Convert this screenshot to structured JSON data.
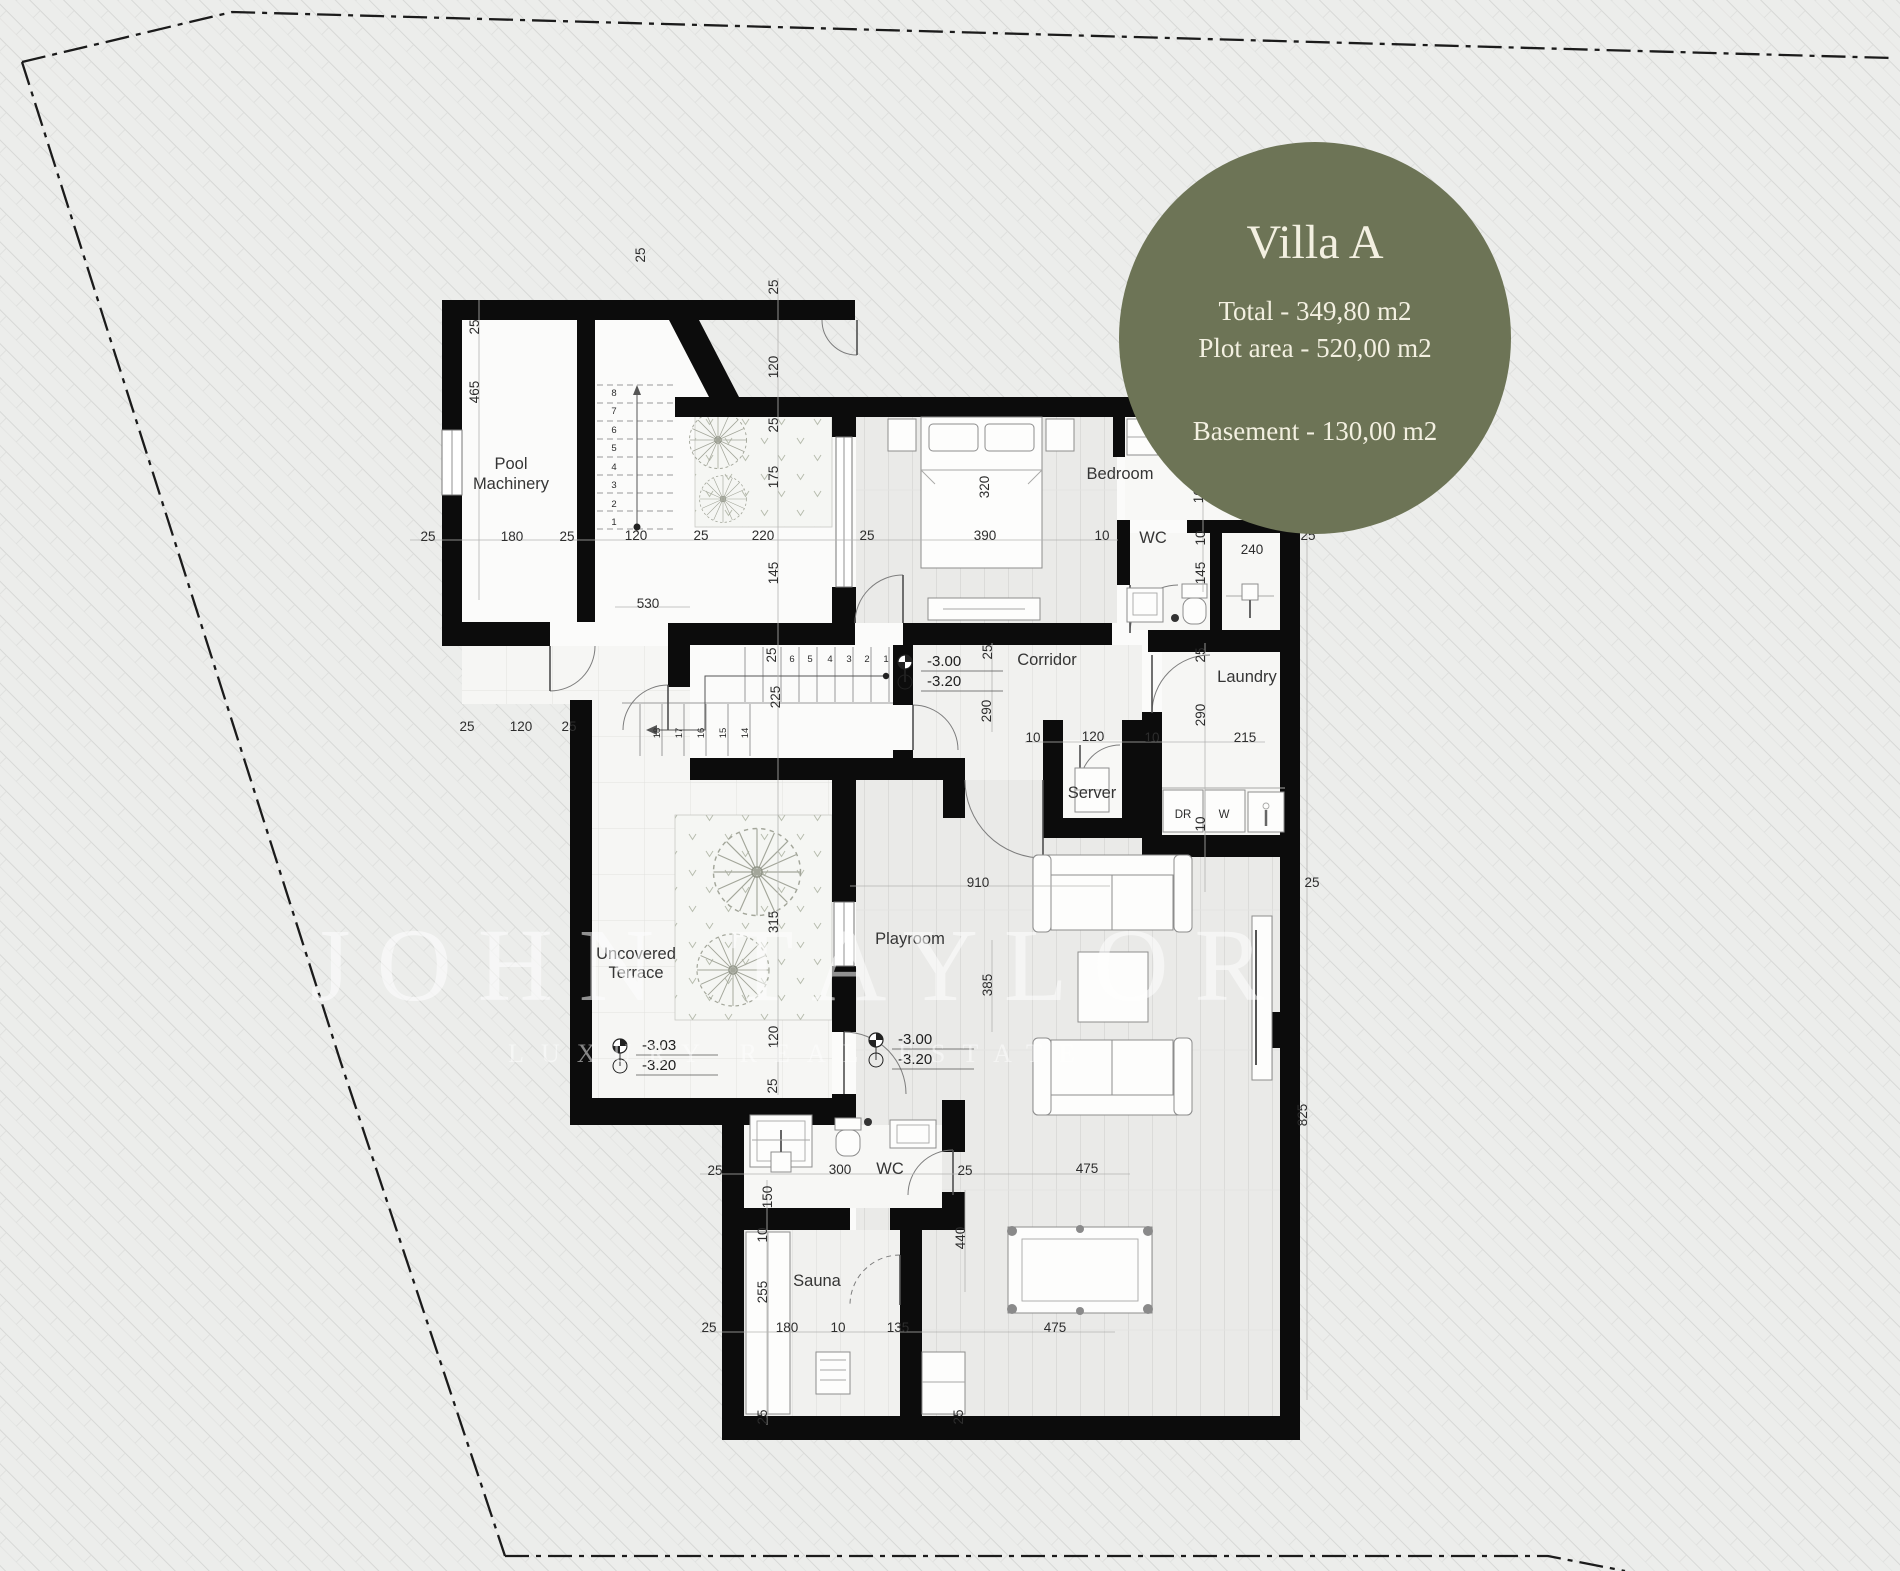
{
  "badge": {
    "title": "Villa A",
    "line1": "Total - 349,80 m2",
    "line2": "Plot area - 520,00 m2",
    "line3": "Basement - 130,00 m2"
  },
  "watermark": {
    "line1": "JOHN TAYLOR",
    "line2": "LUXURY REAL ESTATE"
  },
  "colors": {
    "badge_bg": "#6d7456",
    "badge_fg": "#f3f0e1",
    "wall": "#0c0c0c",
    "paper": "#ecedeb",
    "tree": "#a3a69a"
  },
  "plan": {
    "rooms": [
      {
        "t": "Pool",
        "x": 511,
        "y": 469
      },
      {
        "t": "Machinery",
        "x": 511,
        "y": 489
      },
      {
        "t": "Bedroom",
        "x": 1120,
        "y": 479
      },
      {
        "t": "WC",
        "x": 1153,
        "y": 543
      },
      {
        "t": "Corridor",
        "x": 1047,
        "y": 665
      },
      {
        "t": "Laundry",
        "x": 1247,
        "y": 682
      },
      {
        "t": "Server",
        "x": 1092,
        "y": 798
      },
      {
        "t": "Uncovered",
        "x": 636,
        "y": 959
      },
      {
        "t": "Terrace",
        "x": 636,
        "y": 978
      },
      {
        "t": "Playroom",
        "x": 910,
        "y": 944
      },
      {
        "t": "WC",
        "x": 890,
        "y": 1174
      },
      {
        "t": "Sauna",
        "x": 817,
        "y": 1286
      }
    ],
    "dims": [
      {
        "t": "25",
        "x": 428,
        "y": 541
      },
      {
        "t": "180",
        "x": 512,
        "y": 541
      },
      {
        "t": "25",
        "x": 567,
        "y": 541
      },
      {
        "t": "120",
        "x": 636,
        "y": 540
      },
      {
        "t": "25",
        "x": 701,
        "y": 540
      },
      {
        "t": "220",
        "x": 763,
        "y": 540
      },
      {
        "t": "25",
        "x": 867,
        "y": 540
      },
      {
        "t": "390",
        "x": 985,
        "y": 540
      },
      {
        "t": "10",
        "x": 1102,
        "y": 540
      },
      {
        "t": "25",
        "x": 479,
        "y": 327,
        "r": 1
      },
      {
        "t": "465",
        "x": 479,
        "y": 392,
        "r": 1
      },
      {
        "t": "25",
        "x": 645,
        "y": 255,
        "r": 1
      },
      {
        "t": "25",
        "x": 778,
        "y": 287,
        "r": 1
      },
      {
        "t": "120",
        "x": 778,
        "y": 367,
        "r": 1
      },
      {
        "t": "25",
        "x": 778,
        "y": 425,
        "r": 1
      },
      {
        "t": "175",
        "x": 778,
        "y": 477,
        "r": 1
      },
      {
        "t": "145",
        "x": 778,
        "y": 573,
        "r": 1
      },
      {
        "t": "25",
        "x": 776,
        "y": 655,
        "r": 1
      },
      {
        "t": "225",
        "x": 780,
        "y": 697,
        "r": 1
      },
      {
        "t": "320",
        "x": 989,
        "y": 487,
        "r": 1
      },
      {
        "t": "530",
        "x": 648,
        "y": 608
      },
      {
        "t": "25",
        "x": 467,
        "y": 731
      },
      {
        "t": "120",
        "x": 521,
        "y": 731
      },
      {
        "t": "25",
        "x": 569,
        "y": 731
      },
      {
        "t": "25",
        "x": 1203,
        "y": 383,
        "r": 1
      },
      {
        "t": "165",
        "x": 1203,
        "y": 492,
        "r": 1
      },
      {
        "t": "10",
        "x": 1205,
        "y": 538,
        "r": 1
      },
      {
        "t": "145",
        "x": 1205,
        "y": 573,
        "r": 1
      },
      {
        "t": "240",
        "x": 1252,
        "y": 554
      },
      {
        "t": "25",
        "x": 1308,
        "y": 540
      },
      {
        "t": "25",
        "x": 992,
        "y": 652,
        "r": 1
      },
      {
        "t": "290",
        "x": 991,
        "y": 711,
        "r": 1
      },
      {
        "t": "25",
        "x": 1205,
        "y": 655,
        "r": 1
      },
      {
        "t": "290",
        "x": 1205,
        "y": 715,
        "r": 1
      },
      {
        "t": "215",
        "x": 1245,
        "y": 742
      },
      {
        "t": "10",
        "x": 1033,
        "y": 742
      },
      {
        "t": "120",
        "x": 1093,
        "y": 741
      },
      {
        "t": "10",
        "x": 1152,
        "y": 742
      },
      {
        "t": "DR",
        "x": 1183,
        "y": 818,
        "s": 11
      },
      {
        "t": "W",
        "x": 1224,
        "y": 818,
        "s": 11
      },
      {
        "t": "10",
        "x": 1205,
        "y": 824,
        "r": 1
      },
      {
        "t": "25",
        "x": 1312,
        "y": 887
      },
      {
        "t": "910",
        "x": 978,
        "y": 887
      },
      {
        "t": "385",
        "x": 992,
        "y": 985,
        "r": 1
      },
      {
        "t": "825",
        "x": 1307,
        "y": 1115,
        "r": 1
      },
      {
        "t": "315",
        "x": 778,
        "y": 922,
        "r": 1
      },
      {
        "t": "120",
        "x": 778,
        "y": 1037,
        "r": 1
      },
      {
        "t": "25",
        "x": 777,
        "y": 1086,
        "r": 1
      },
      {
        "t": "25",
        "x": 715,
        "y": 1175
      },
      {
        "t": "300",
        "x": 840,
        "y": 1174
      },
      {
        "t": "25",
        "x": 965,
        "y": 1175
      },
      {
        "t": "475",
        "x": 1087,
        "y": 1173
      },
      {
        "t": "150",
        "x": 772,
        "y": 1197,
        "r": 1
      },
      {
        "t": "10",
        "x": 767,
        "y": 1235,
        "r": 1
      },
      {
        "t": "255",
        "x": 767,
        "y": 1292,
        "r": 1
      },
      {
        "t": "440",
        "x": 965,
        "y": 1238,
        "r": 1
      },
      {
        "t": "25",
        "x": 709,
        "y": 1332
      },
      {
        "t": "180",
        "x": 787,
        "y": 1332
      },
      {
        "t": "10",
        "x": 838,
        "y": 1332
      },
      {
        "t": "135",
        "x": 898,
        "y": 1332
      },
      {
        "t": "475",
        "x": 1055,
        "y": 1332
      },
      {
        "t": "25",
        "x": 767,
        "y": 1417,
        "r": 1
      },
      {
        "t": "25",
        "x": 963,
        "y": 1417,
        "r": 1
      }
    ],
    "stairs": [
      {
        "t": "8",
        "x": 614,
        "y": 396
      },
      {
        "t": "7",
        "x": 614,
        "y": 414
      },
      {
        "t": "6",
        "x": 614,
        "y": 433
      },
      {
        "t": "5",
        "x": 614,
        "y": 451
      },
      {
        "t": "4",
        "x": 614,
        "y": 470
      },
      {
        "t": "3",
        "x": 614,
        "y": 488
      },
      {
        "t": "2",
        "x": 614,
        "y": 507
      },
      {
        "t": "1",
        "x": 614,
        "y": 525
      },
      {
        "t": "1",
        "x": 886,
        "y": 662
      },
      {
        "t": "2",
        "x": 867,
        "y": 662
      },
      {
        "t": "3",
        "x": 849,
        "y": 662
      },
      {
        "t": "4",
        "x": 830,
        "y": 662
      },
      {
        "t": "5",
        "x": 810,
        "y": 662
      },
      {
        "t": "6",
        "x": 792,
        "y": 662
      },
      {
        "t": "14",
        "x": 748,
        "y": 733,
        "r": 1
      },
      {
        "t": "15",
        "x": 726,
        "y": 733,
        "r": 1
      },
      {
        "t": "16",
        "x": 704,
        "y": 733,
        "r": 1
      },
      {
        "t": "17",
        "x": 682,
        "y": 733,
        "r": 1
      },
      {
        "t": "18",
        "x": 660,
        "y": 733,
        "r": 1
      }
    ],
    "levels": [
      {
        "v1": "-3.00",
        "v2": "-3.20",
        "x": 905,
        "y": 662
      },
      {
        "v1": "-3.03",
        "v2": "-3.20",
        "x": 620,
        "y": 1046
      },
      {
        "v1": "-3.00",
        "v2": "-3.20",
        "x": 876,
        "y": 1040
      }
    ]
  }
}
